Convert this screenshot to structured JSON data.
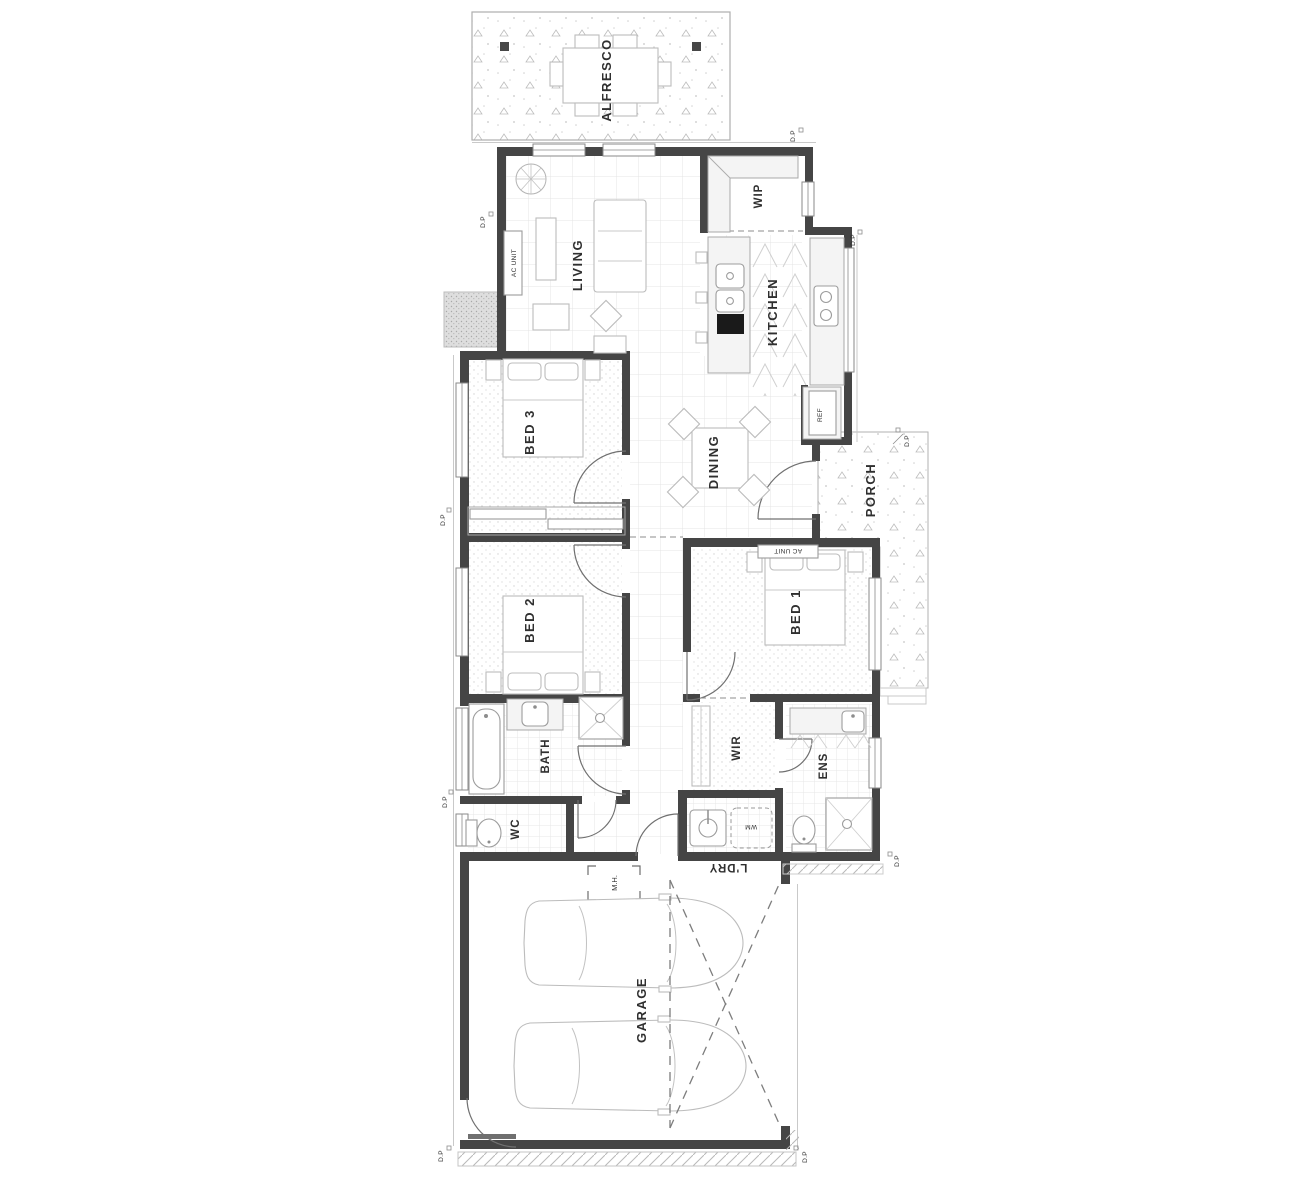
{
  "plan": {
    "rooms": {
      "alfresco": "ALFRESCO",
      "living": "LIVING",
      "wip": "WIP",
      "kitchen": "KITCHEN",
      "bed3": "BED 3",
      "dining": "DINING",
      "porch": "PORCH",
      "bed2": "BED 2",
      "bed1": "BED 1",
      "bath": "BATH",
      "wc": "WC",
      "wir": "WIR",
      "ens": "ENS",
      "ldry": "L'DRY",
      "garage": "GARAGE"
    },
    "fixtures": {
      "ac_unit": "AC UNIT",
      "ref": "REF",
      "wm": "WM",
      "mh": "M.H.",
      "dp": "D.P"
    },
    "colors": {
      "wall": "#454545",
      "line": "#b5b5b5",
      "text": "#2f2f2f",
      "paper": "#ffffff"
    }
  }
}
